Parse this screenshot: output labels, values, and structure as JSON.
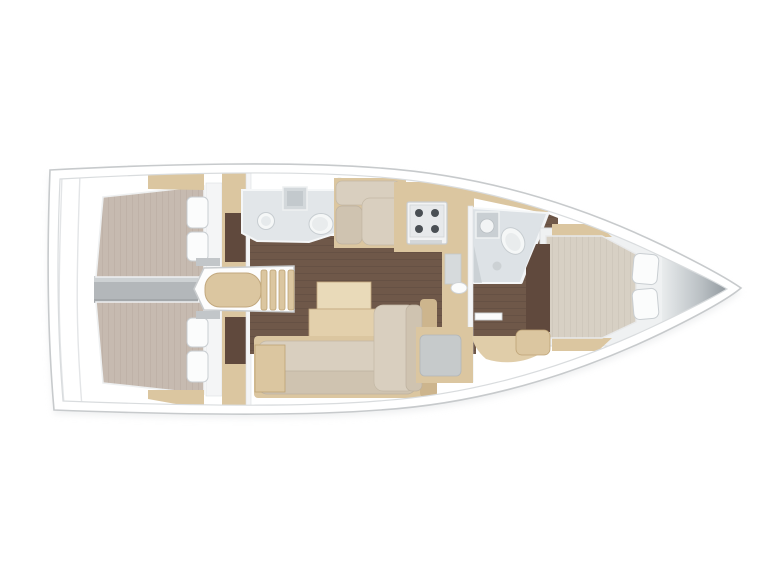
{
  "canvas": {
    "width": 768,
    "height": 576,
    "background": "#ffffff"
  },
  "diagram": {
    "type": "boat-floorplan",
    "view": "top-down interior layout of a sailing yacht, bow pointing right",
    "visible_text": "none"
  },
  "palette": {
    "hull_stroke": "#c7cacc",
    "deck_line": "#d9dcde",
    "floor_walnut": "#6f5849",
    "floor_plank_line": "#5f4a3f",
    "wood_light": "#dbc6a0",
    "wood_mid": "#cdb58d",
    "cushion_beige": "#d9cfbf",
    "cushion_dark": "#cfc3b0",
    "mattress_aft": "#c6bab0",
    "mattress_fwd": "#d7d0c4",
    "bath_gray": "#e2e6e9",
    "metal_gray": "#b3b7ba",
    "wardrobe_brown": "#60493d",
    "nav_seat_gray": "#c6cacb",
    "bow_dark": "#878f95"
  },
  "regions": [
    {
      "id": "aft-cabin-port",
      "label": "aft double cabin (top)"
    },
    {
      "id": "aft-cabin-starboard",
      "label": "aft double cabin (bottom)"
    },
    {
      "id": "engine-compartment",
      "label": "engine space between aft cabins"
    },
    {
      "id": "companionway",
      "label": "companionway steps"
    },
    {
      "id": "aft-head",
      "label": "aft bathroom with sink and toilet"
    },
    {
      "id": "salon",
      "label": "salon with table and settees"
    },
    {
      "id": "galley",
      "label": "galley with 4-burner stove"
    },
    {
      "id": "nav-station",
      "label": "nav seat"
    },
    {
      "id": "forward-head",
      "label": "forward bathroom with shower"
    },
    {
      "id": "forward-cabin",
      "label": "forward double cabin"
    },
    {
      "id": "bow-locker",
      "label": "anchor locker at bow"
    }
  ]
}
